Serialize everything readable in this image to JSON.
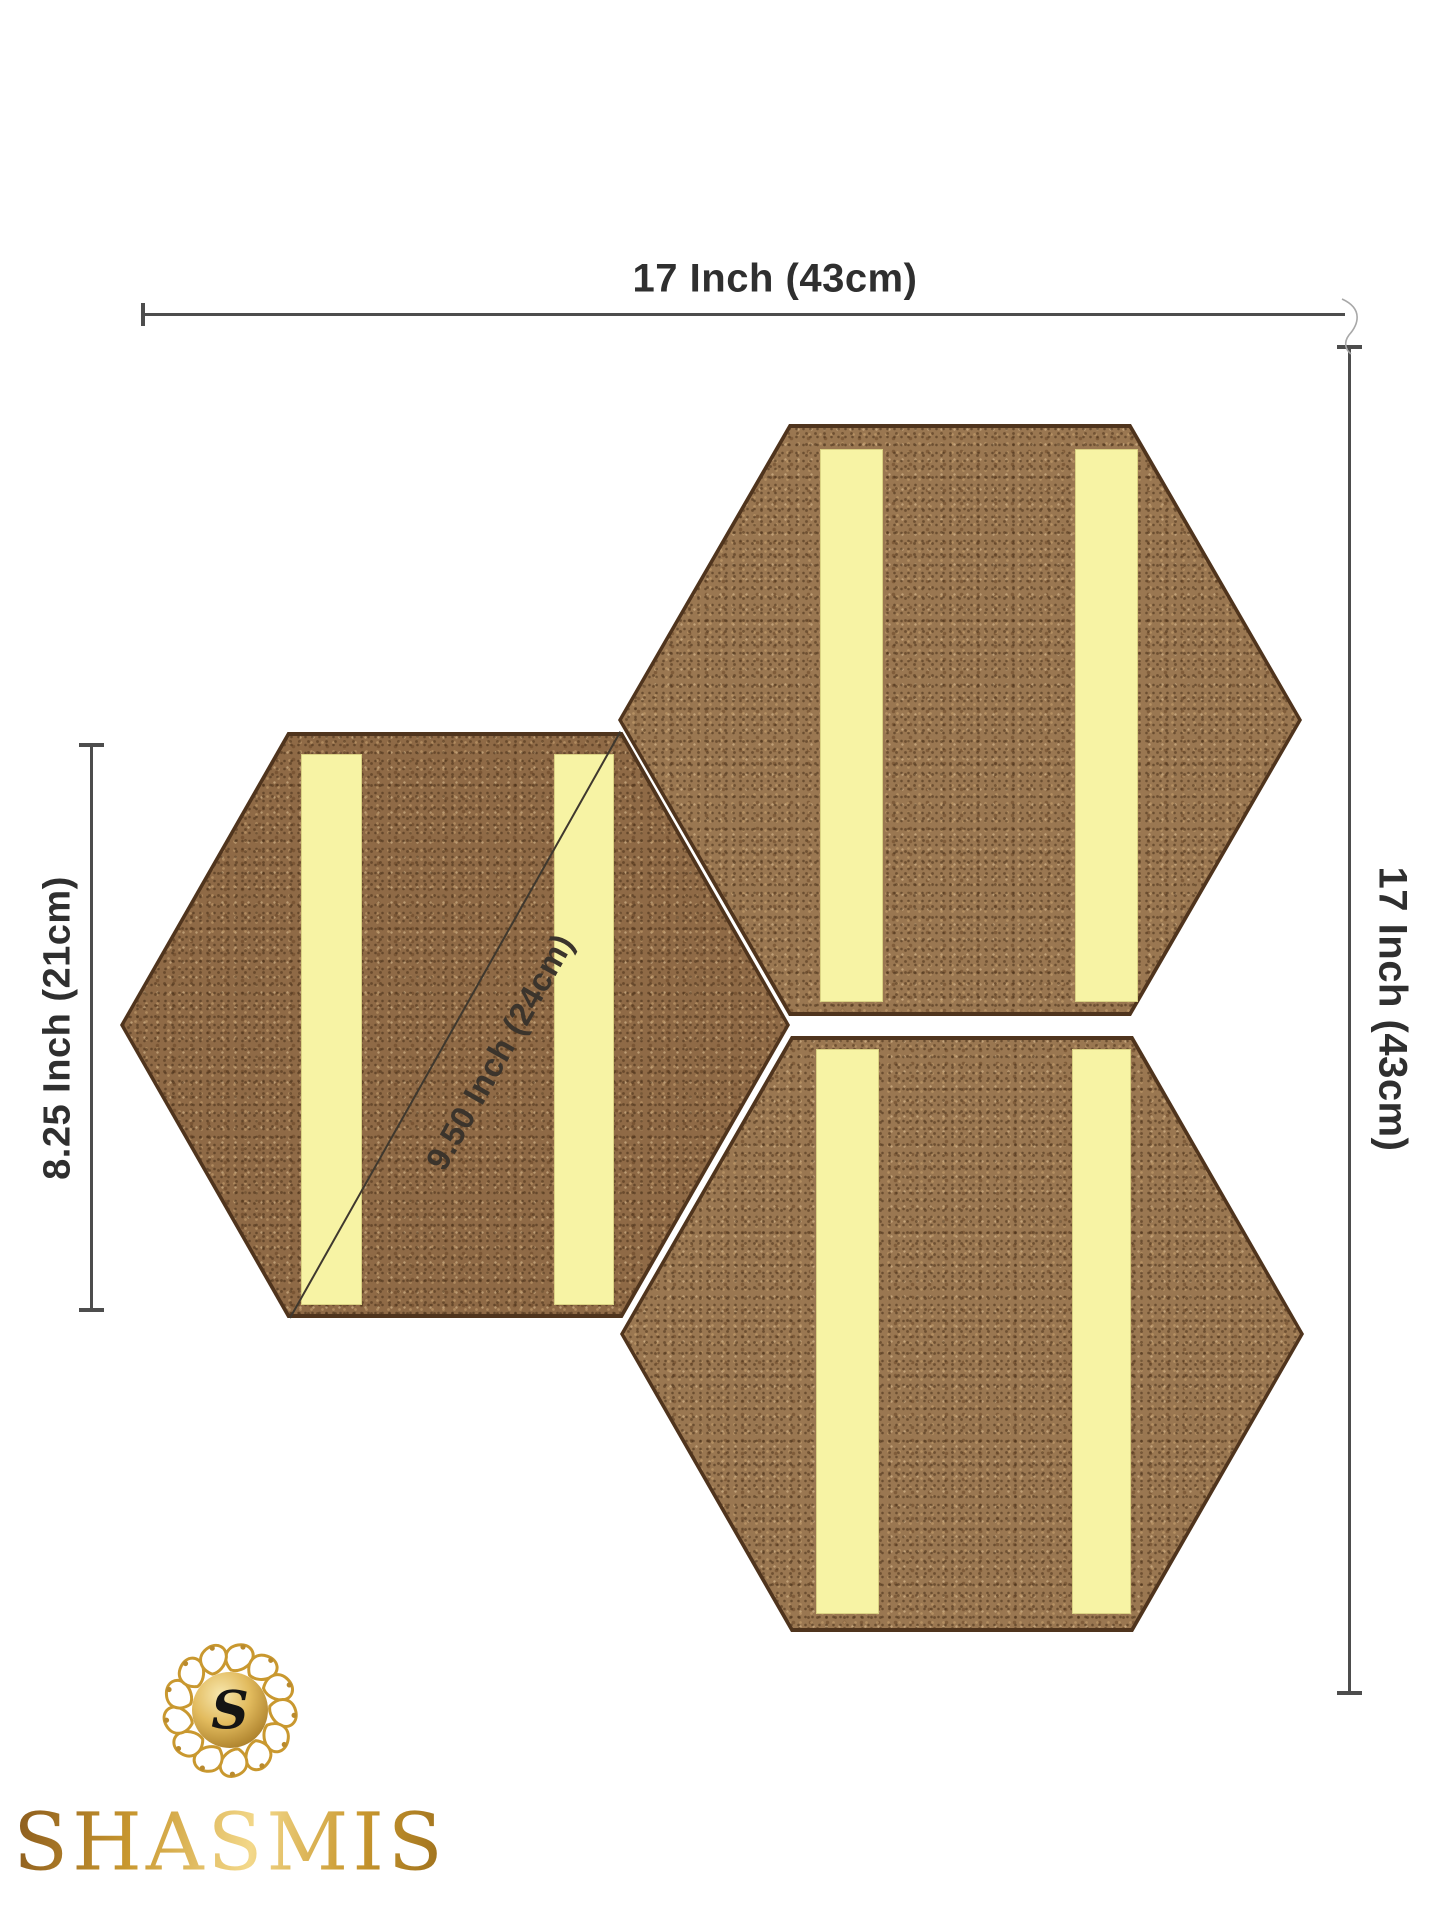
{
  "title": "Hexagon cork board set dimension diagram",
  "dimensions": {
    "top": {
      "label": "17 Inch (43cm)"
    },
    "right": {
      "label": "17 Inch (43cm)"
    },
    "left": {
      "label": "8.25 Inch (21cm)"
    },
    "diagonal": {
      "label": "9.50 Inch (24cm)"
    }
  },
  "boards": {
    "count": 3,
    "shape": "hexagon",
    "material": "cork",
    "adhesive_strips_per_board": 2
  },
  "brand": {
    "name": "SHASMIS",
    "monogram": "S"
  },
  "colors": {
    "cork": "#9a7751",
    "cork_border": "#4f341d",
    "strip_yellow": "#f7f3a4",
    "dimension_line": "#4d4d4d",
    "label_text": "#2f2f2f",
    "logo_gold": "#c9982f",
    "logo_gold_dark": "#8a5f17",
    "logo_gold_light": "#f3d88a",
    "monogram_color": "#141414"
  }
}
